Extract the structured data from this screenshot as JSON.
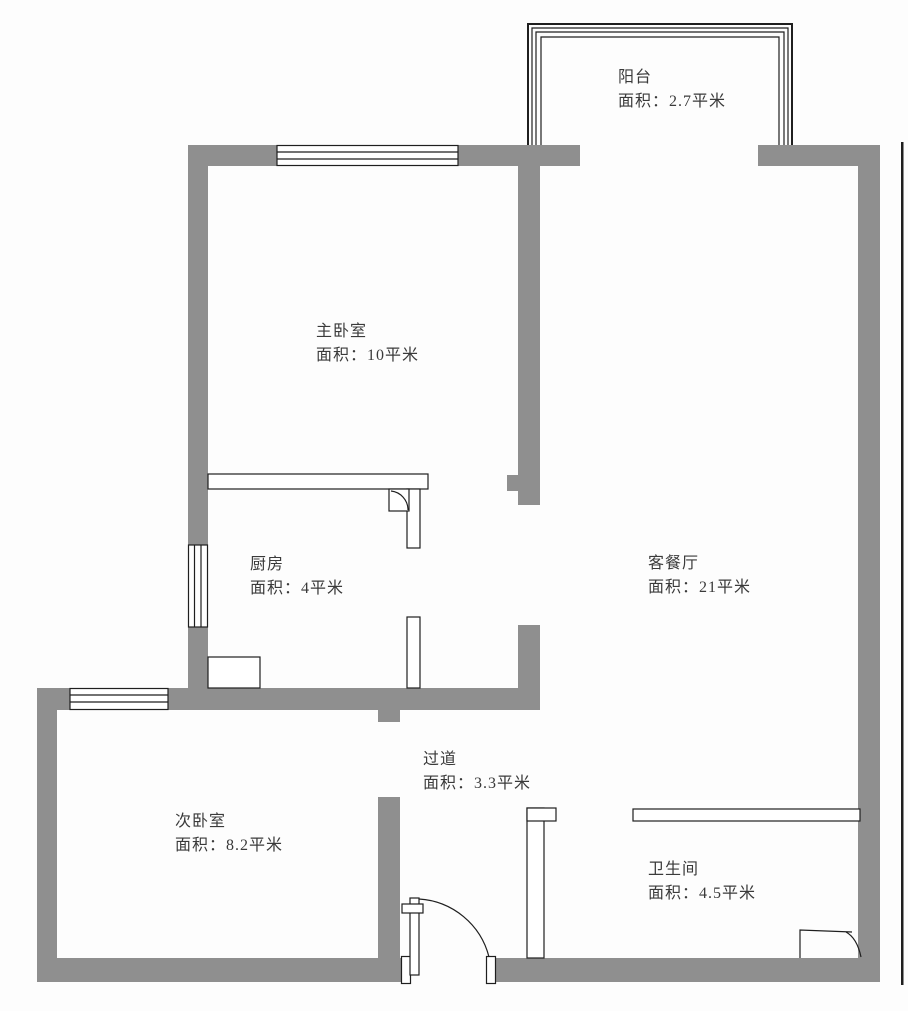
{
  "title": "户型图",
  "rooms": [
    {
      "id": "balcony",
      "name": "阳台",
      "area": "面积：2.7平米"
    },
    {
      "id": "master-bedroom",
      "name": "主卧室",
      "area": "面积：10平米"
    },
    {
      "id": "living-dining",
      "name": "客餐厅",
      "area": "面积：21平米"
    },
    {
      "id": "kitchen",
      "name": "厨房",
      "area": "面积：4平米"
    },
    {
      "id": "hallway",
      "name": "过道",
      "area": "面积：3.3平米"
    },
    {
      "id": "second-bedroom",
      "name": "次卧室",
      "area": "面积：8.2平米"
    },
    {
      "id": "bathroom",
      "name": "卫生间",
      "area": "面积：4.5平米"
    }
  ],
  "colors": {
    "wall": "#8f8f8f",
    "line": "#1f1f1f",
    "background": "#fdfdfd",
    "text": "#3a3a3a"
  }
}
